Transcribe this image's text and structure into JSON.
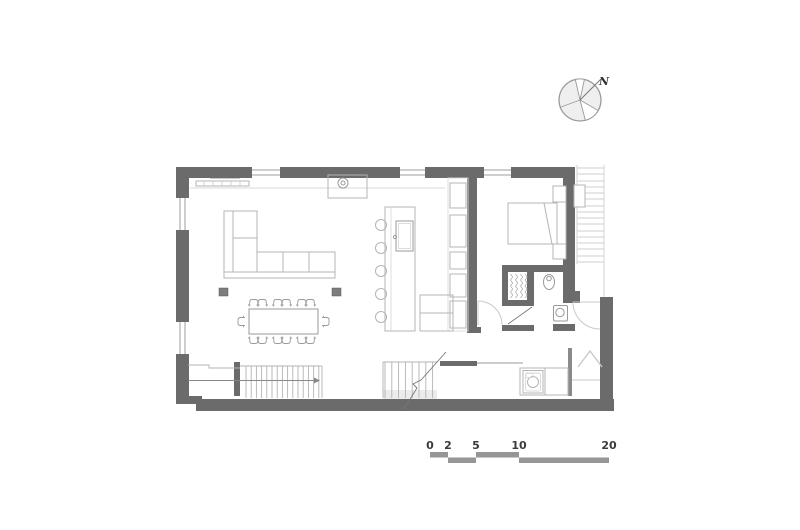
{
  "drawing": {
    "kind": "architectural floor plan",
    "north_indicator": {
      "label": "N"
    },
    "scale_bar": {
      "labels": [
        "0",
        "2",
        "5",
        "10",
        "20"
      ]
    },
    "symbols": [
      "north-compass",
      "scale-bar",
      "exterior-walls",
      "windows",
      "interior-doors",
      "sofa",
      "dining-table",
      "dining-chairs",
      "structural-columns",
      "kitchen-island",
      "bar-stools",
      "island-sink",
      "wall-cabinets",
      "kitchen-counter",
      "cooktop",
      "radiator",
      "bed",
      "nightstands",
      "wardrobe-closet",
      "toilet",
      "washbasin",
      "washing-machine",
      "laundry-counter",
      "main-staircase",
      "basement-staircase",
      "exterior-staircase",
      "entry-door"
    ]
  },
  "colors": {
    "wall": "#6b6b6b",
    "furniture": "#b5b5b5",
    "detail": "#9a9a9a",
    "scalebar": "#969696",
    "text": "#3a3a3a",
    "hatch": "#c9c9c9",
    "bg": "#ffffff"
  }
}
